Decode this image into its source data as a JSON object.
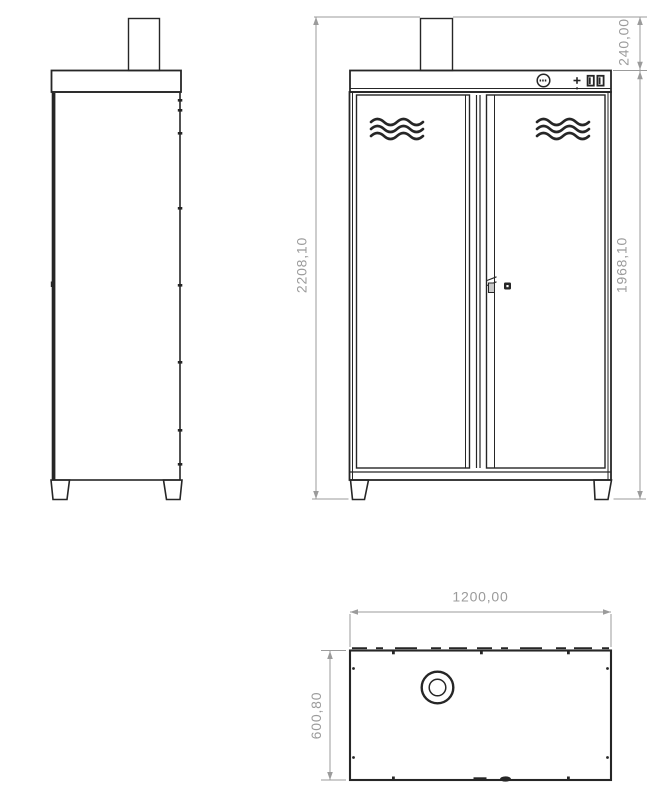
{
  "colors": {
    "background": "#ffffff",
    "line_color": "#262626",
    "dimension_color": "#9b9b9b"
  },
  "dimension_labels": {
    "chimney_height": "240,00",
    "total_height": "2208,10",
    "body_height": "1968,10",
    "width": "1200,00",
    "depth": "600,80"
  }
}
